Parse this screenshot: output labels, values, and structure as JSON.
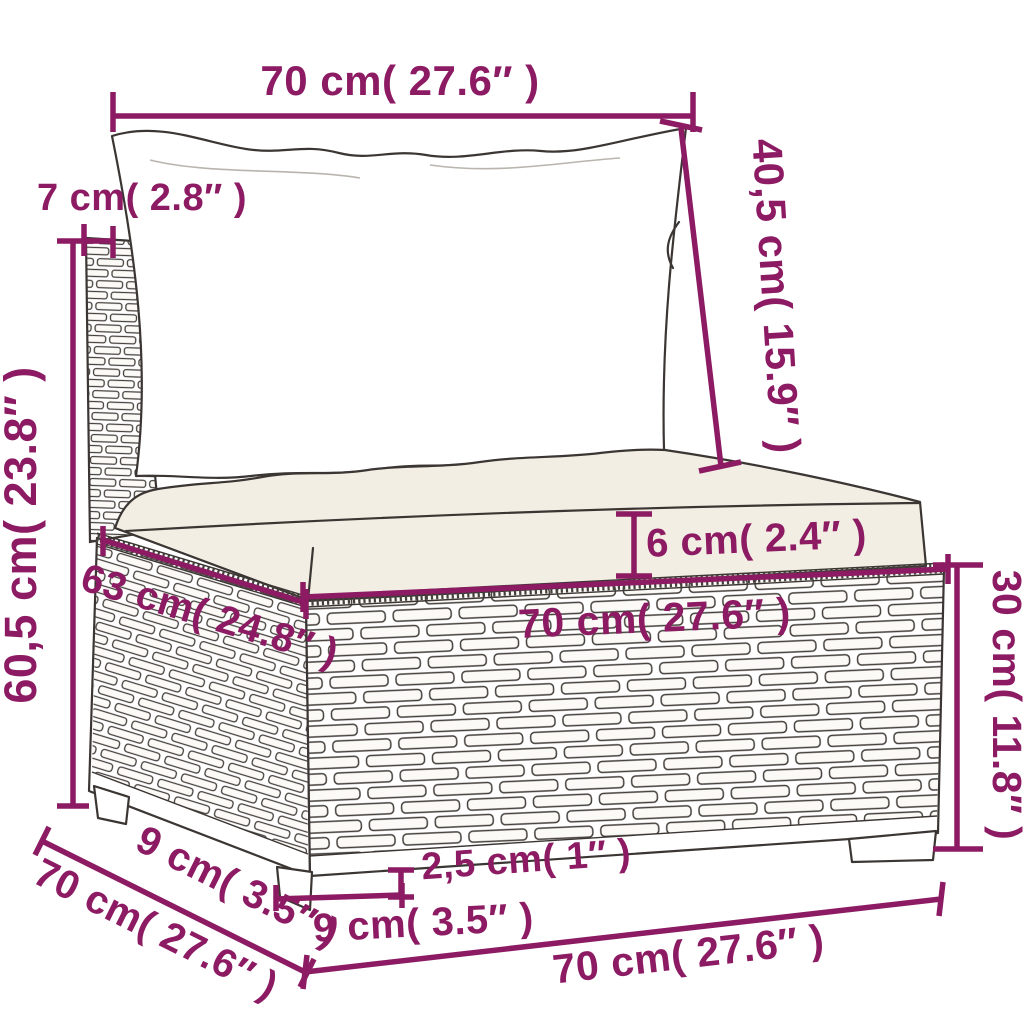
{
  "colors": {
    "dimension_accent": "#8C1B63",
    "line_color": "#3B3633",
    "cushion_fill": "#F2EEE3",
    "background": "#FFFFFF"
  },
  "dims": {
    "back_cushion_width_top": "70 cm( 27.6″ )",
    "back_panel_thickness": "7 cm( 2.8″ )",
    "back_cushion_height": "40,5 cm( 15.9″ )",
    "backrest_height": "60,5 cm( 23.8″ )",
    "seat_cushion_thickness": "6 cm( 2.4″ )",
    "seat_depth": "63 cm( 24.8″ )",
    "seat_width": "70 cm( 27.6″ )",
    "base_height": "30 cm( 11.8″ )",
    "ground_clearance": "2,5 cm( 1″ )",
    "front_leg_width": "9 cm( 3.5″ )",
    "side_leg_width": "9 cm( 3.5″ )",
    "overall_depth": "70 cm( 27.6″ )",
    "overall_width_bottom": "70 cm( 27.6″ )"
  }
}
